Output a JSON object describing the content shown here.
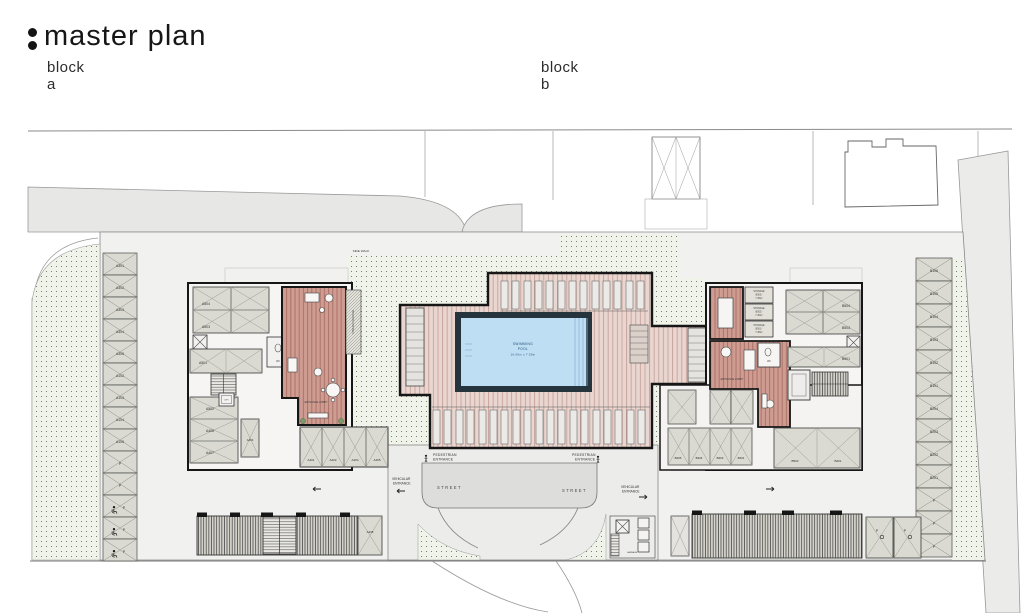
{
  "header": {
    "title": "master plan",
    "block_a": "block a",
    "block_b": "block b"
  },
  "plan": {
    "side_walk": "SIDE WALK",
    "street": "STREET",
    "pedestrian_line1": "PEDESTRIAN",
    "pedestrian_line2": "ENTRANCE",
    "vehicular_line1": "VEHICULAR",
    "vehicular_line2": "ENTRANCE",
    "entrance_lobby": "ENTRANCE LOBBY",
    "wc": "WC",
    "covered_veranda": "COVERED VERANDA",
    "lift": "LIFT",
    "garbage": "GARBAGE",
    "pool": {
      "line1": "SWIMMING",
      "line2": "POOL",
      "dimensions": "16.00m x 7.50m"
    },
    "parking_left": [
      "A301",
      "A302",
      "A303",
      "A304",
      "A305",
      "A102",
      "A103",
      "A104",
      "A105",
      "P",
      "P",
      "P",
      "P",
      "P"
    ],
    "parking_right": [
      "B106",
      "B105",
      "B104",
      "B103",
      "B102",
      "B101",
      "B204",
      "B203",
      "B202",
      "B201",
      "P",
      "P",
      "P"
    ],
    "building_a": {
      "stall_top": [
        "A504",
        "A503"
      ],
      "stall_mid": "A501",
      "stall_left": [
        "A502",
        "A406",
        "A407"
      ],
      "stall_vertical": "A403",
      "stall_bottom": [
        "A401",
        "A402",
        "A404",
        "A405"
      ],
      "garage_stall": "A408"
    },
    "building_b": {
      "storage": [
        {
          "label": "STORAGE",
          "id": "B503 /",
          "area": "7.36m²"
        },
        {
          "label": "STORAGE",
          "id": "B502 /",
          "area": "7.30m²"
        },
        {
          "label": "STORAGE",
          "id": "B501 /",
          "area": "7.36m²"
        }
      ],
      "stall_right": [
        "B504",
        "B503"
      ],
      "stall_mid": "B501",
      "stall_low": [
        "B502",
        "B201"
      ],
      "stall_bottom": [
        "B405",
        "B404",
        "B403",
        "B401"
      ],
      "visitor_stalls": [
        "P",
        "P"
      ]
    },
    "colors": {
      "deck": "#e9d6d0",
      "lobby": "#cf9c92",
      "pool_water": "#bedef4",
      "landscape_bg": "#eff3ea",
      "wall": "#161616"
    }
  }
}
